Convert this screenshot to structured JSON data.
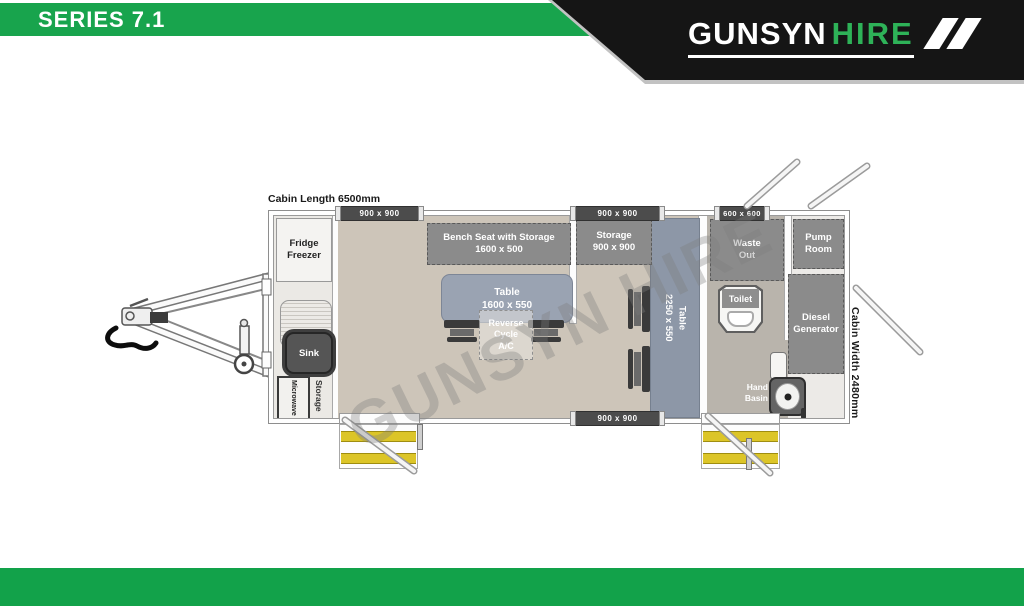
{
  "header": {
    "series_label": "SERIES 7.1",
    "brand": {
      "name_primary": "GUNSYN",
      "name_secondary": "HIRE"
    }
  },
  "watermark": "GUNSYN HIRE",
  "plan": {
    "cabin_length_label": "Cabin Length 6500mm",
    "cabin_width_label": "Cabin Width 2480mm",
    "doors": {
      "top_left": "900 x 900",
      "top_middle": "900 x 900",
      "top_right": "600 x 600",
      "bottom": "900 x 900"
    },
    "rooms": {
      "fridge": {
        "line1": "Fridge",
        "line2": "Freezer"
      },
      "bench": {
        "line1": "Bench Seat with Storage",
        "line2": "1600 x 500"
      },
      "table_main": {
        "line1": "Table",
        "line2": "1600 x 550"
      },
      "ac": {
        "line1": "Reverse",
        "line2": "Cycle",
        "line3": "A/C"
      },
      "storage_room": {
        "line1": "Storage",
        "line2": "900 x 900"
      },
      "table_long": {
        "line1": "Table",
        "line2": "2250 x 550"
      },
      "waste_out": {
        "line1": "Waste",
        "line2": "Out"
      },
      "pump_room": {
        "line1": "Pump",
        "line2": "Room"
      },
      "toilet": "Toilet",
      "diesel": {
        "line1": "Diesel",
        "line2": "Generator"
      },
      "hand_basin": {
        "line1": "Hand",
        "line2": "Basin"
      },
      "sink": "Sink",
      "microwave": "Microwave",
      "storage_small": "Storage"
    }
  },
  "colors": {
    "brand_green": "#18a44d",
    "banner_black": "#151515",
    "logo_hire_green": "#2eb258",
    "furniture_gray": "#8b8b8b",
    "table_blue_gray": "#9aa3b2",
    "floor_beige": "#cdc5b9",
    "toilet_room_floor": "#b9b4ac",
    "step_yellow": "#dcc528"
  }
}
